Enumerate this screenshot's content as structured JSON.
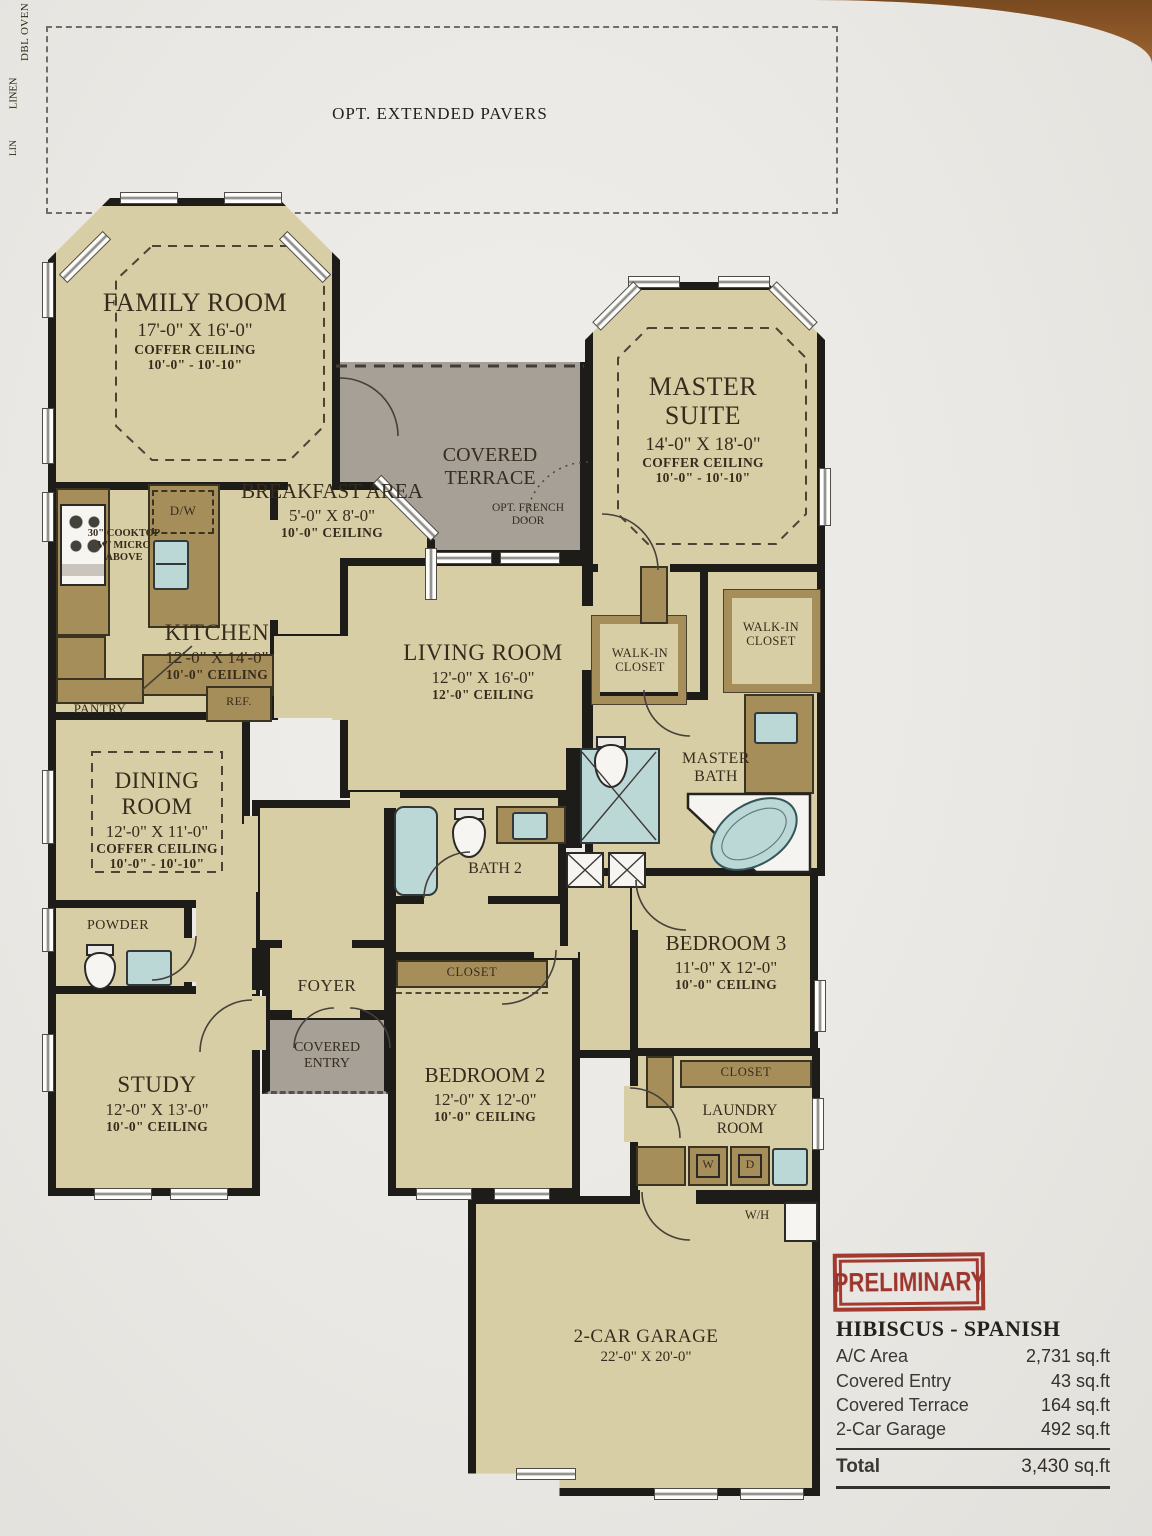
{
  "site": {
    "pavers_label": "OPT. EXTENDED PAVERS"
  },
  "rooms": {
    "family": {
      "name": "FAMILY ROOM",
      "dims": "17'-0\" X 16'-0\"",
      "ceiling_type": "COFFER CEILING",
      "ceiling_height": "10'-0\" - 10'-10\""
    },
    "master": {
      "name": "MASTER SUITE",
      "dims": "14'-0\" X 18'-0\"",
      "ceiling_type": "COFFER CEILING",
      "ceiling_height": "10'-0\" - 10'-10\""
    },
    "breakfast": {
      "name": "BREAKFAST AREA",
      "dims": "5'-0\" X 8'-0\"",
      "ceiling_height": "10'-0\" CEILING"
    },
    "terrace": {
      "name": "COVERED TERRACE",
      "note": "OPT. FRENCH DOOR"
    },
    "kitchen": {
      "name": "KITCHEN",
      "dims": "12'-0\" X 14'-0\"",
      "ceiling_height": "10'-0\" CEILING"
    },
    "living": {
      "name": "LIVING ROOM",
      "dims": "12'-0\" X 16'-0\"",
      "ceiling_height": "12'-0\" CEILING"
    },
    "dining": {
      "name": "DINING ROOM",
      "dims": "12'-0\" X 11'-0\"",
      "ceiling_type": "COFFER CEILING",
      "ceiling_height": "10'-0\" - 10'-10\""
    },
    "master_bath": {
      "name": "MASTER BATH"
    },
    "wic_left": {
      "name": "WALK-IN CLOSET"
    },
    "wic_right": {
      "name": "WALK-IN CLOSET"
    },
    "bath2": {
      "name": "BATH 2"
    },
    "bed3": {
      "name": "BEDROOM 3",
      "dims": "11'-0\" X 12'-0\"",
      "ceiling_height": "10'-0\" CEILING"
    },
    "powder": {
      "name": "POWDER"
    },
    "study": {
      "name": "STUDY",
      "dims": "12'-0\" X 13'-0\"",
      "ceiling_height": "10'-0\" CEILING"
    },
    "foyer": {
      "name": "FOYER"
    },
    "entry": {
      "name": "COVERED ENTRY"
    },
    "bed2": {
      "name": "BEDROOM 2",
      "dims": "12'-0\" X 12'-0\"",
      "ceiling_height": "10'-0\" CEILING"
    },
    "laundry": {
      "name": "LAUNDRY ROOM"
    },
    "garage": {
      "name": "2-CAR GARAGE",
      "dims": "22'-0\" X 20'-0\""
    }
  },
  "fixtures": {
    "cooktop": "30\" COOKTOP W/ MICRO ABOVE",
    "dishwasher": "D/W",
    "double_oven": "DBL OVEN",
    "pantry": "PANTRY",
    "refrigerator": "REF.",
    "linen": "LINEN",
    "lin": "LIN",
    "closet_bed2": "CLOSET",
    "closet_hall": "CLOSET",
    "washer": "W",
    "dryer": "D",
    "water_heater": "W/H"
  },
  "title_block": {
    "stamp": "PRELIMINARY",
    "plan_name": "HIBISCUS - SPANISH",
    "rows": [
      {
        "label": "A/C Area",
        "value": "2,731 sq.ft"
      },
      {
        "label": "Covered Entry",
        "value": "43 sq.ft"
      },
      {
        "label": "Covered Terrace",
        "value": "164 sq.ft"
      },
      {
        "label": "2-Car Garage",
        "value": "492 sq.ft"
      }
    ],
    "total": {
      "label": "Total",
      "value": "3,430 sq.ft"
    }
  }
}
